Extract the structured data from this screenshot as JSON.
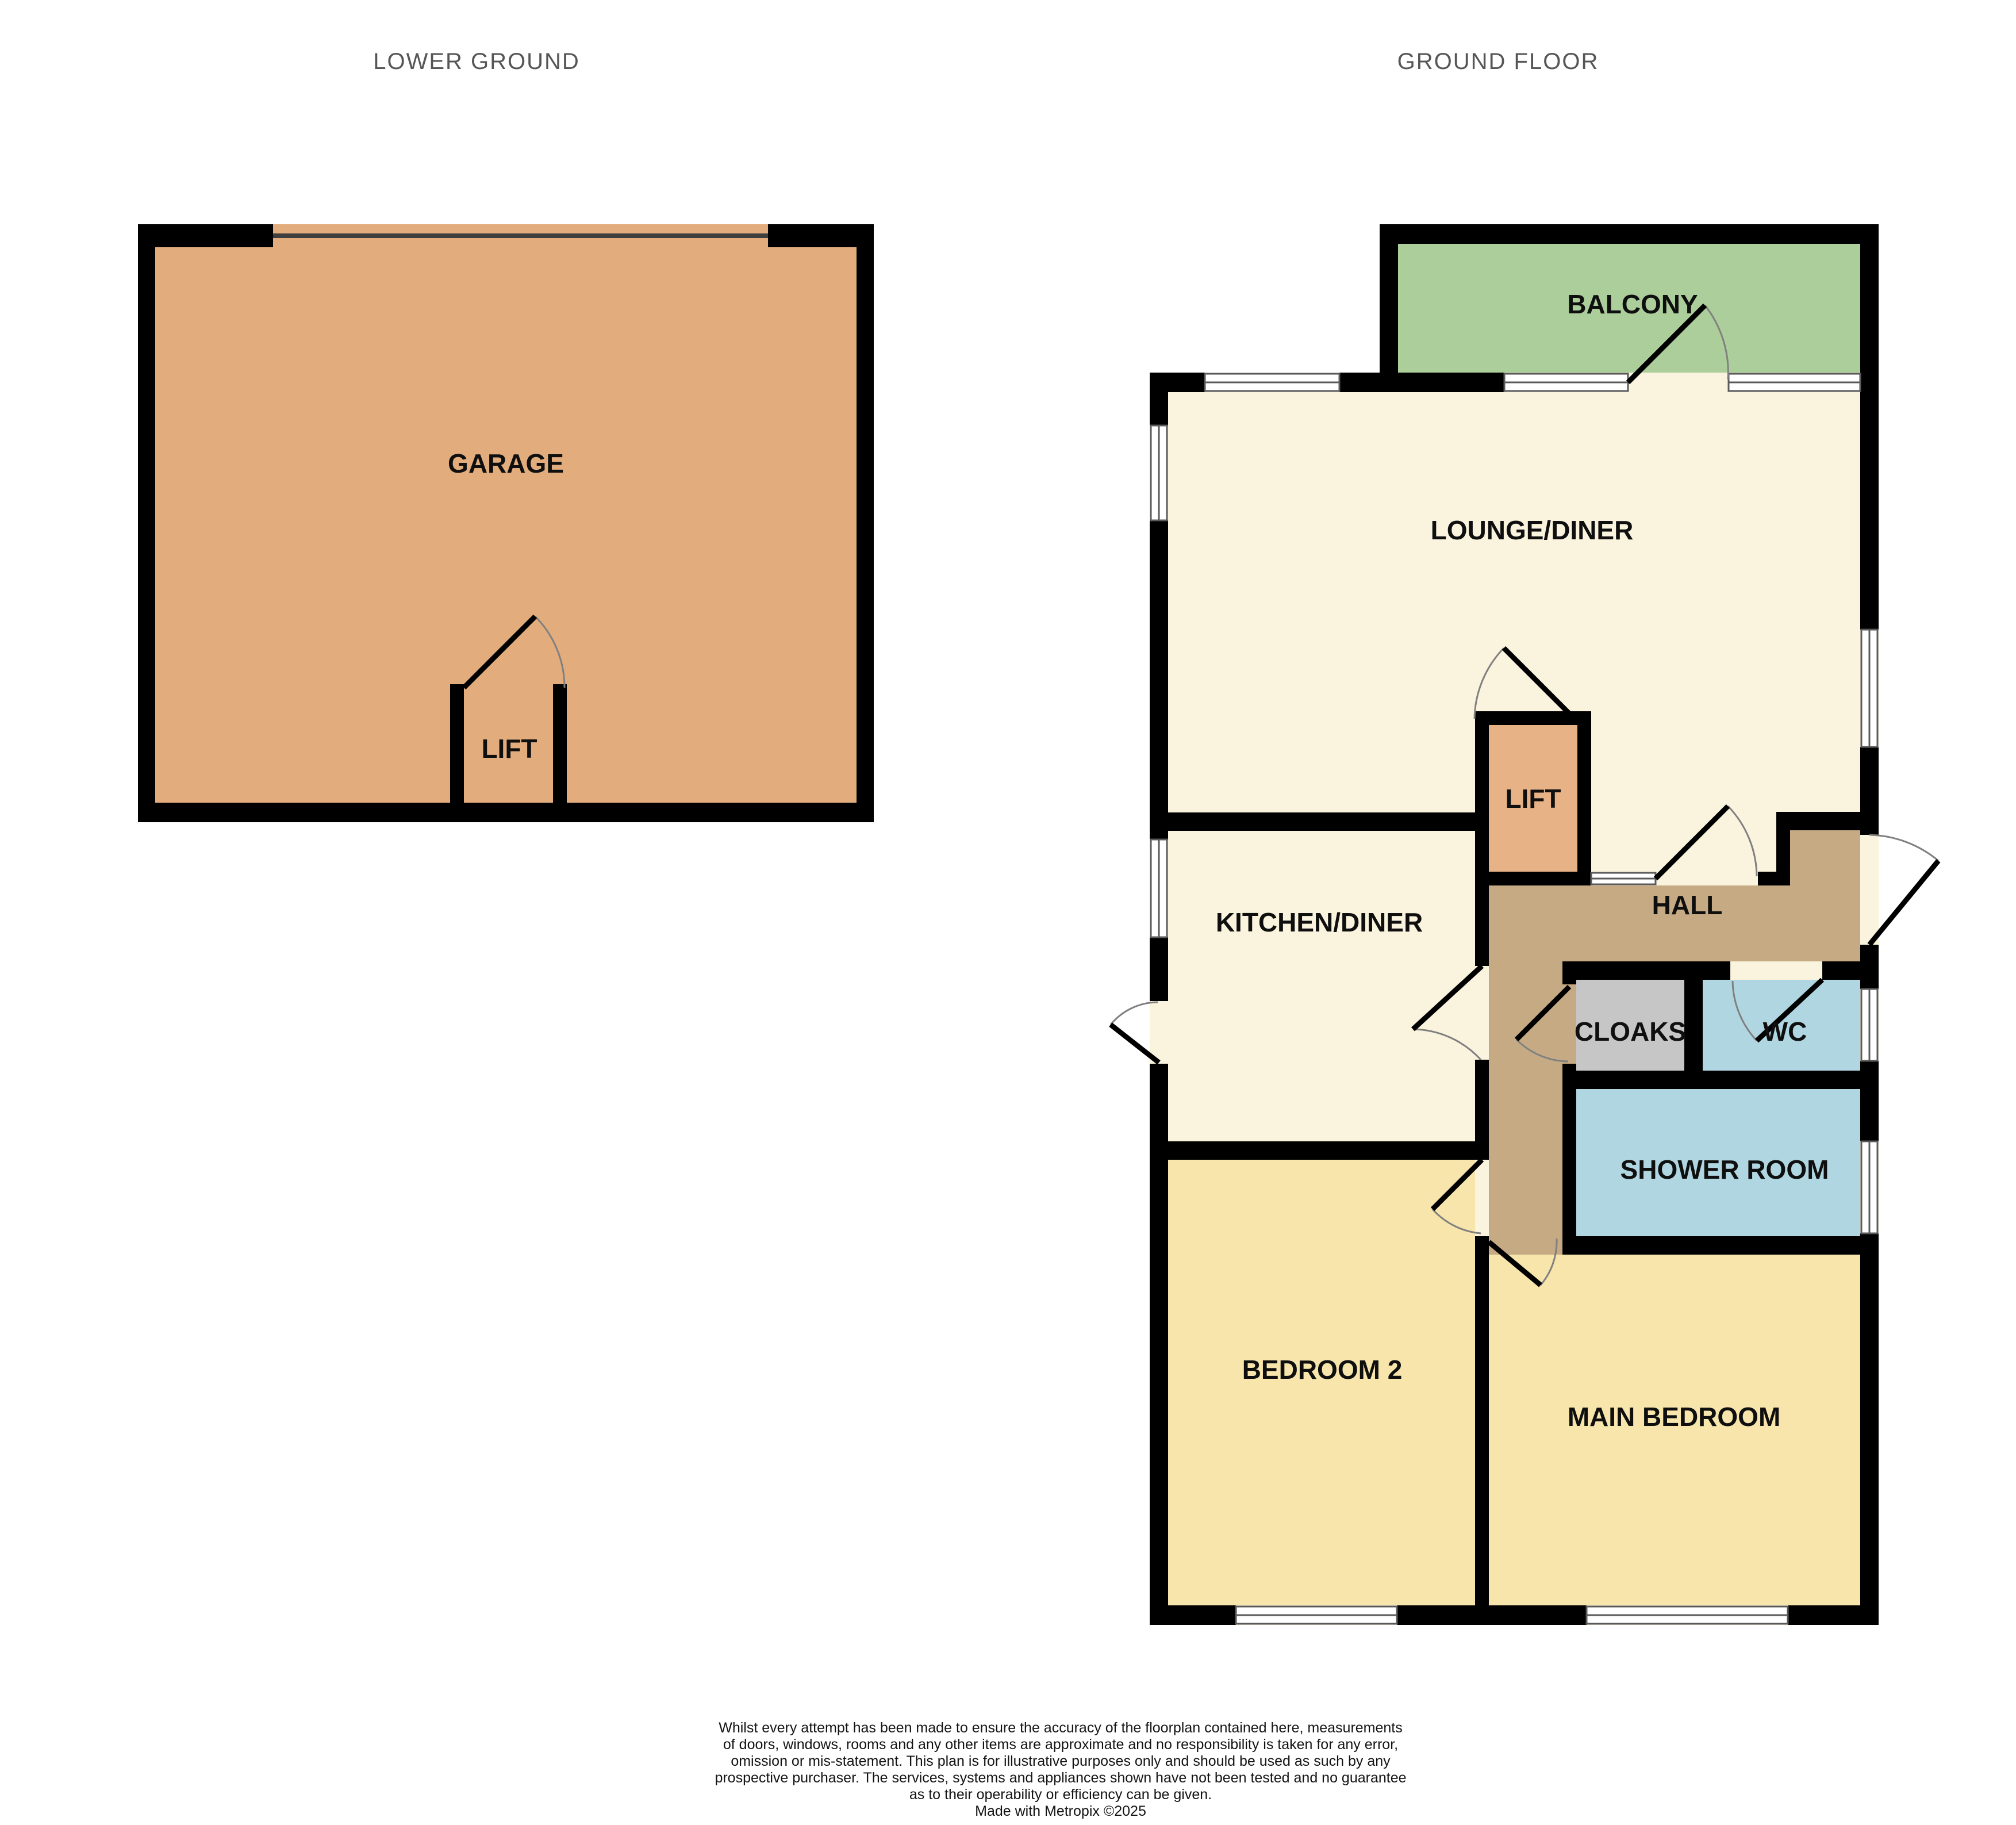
{
  "titles": {
    "lower_ground": "LOWER GROUND",
    "ground_floor": "GROUND FLOOR"
  },
  "rooms": {
    "garage": "GARAGE",
    "lift_lower": "LIFT",
    "balcony": "BALCONY",
    "lounge_diner": "LOUNGE/DINER",
    "lift_ground": "LIFT",
    "kitchen_diner": "KITCHEN/DINER",
    "hall": "HALL",
    "cloaks": "CLOAKS",
    "wc": "WC",
    "shower_room": "SHOWER ROOM",
    "bedroom_2": "BEDROOM 2",
    "main_bedroom": "MAIN BEDROOM"
  },
  "colors": {
    "wall": "#000000",
    "garage": "#E2AC7D",
    "lift": "#E7B286",
    "balcony": "#ABCE9B",
    "cream": "#FAF3DD",
    "hall": "#C5AA83",
    "cloaks": "#C6C6C6",
    "bathroom": "#B0D6E1",
    "bedroom": "#F7E5AB",
    "garage_door_line": "#3F3F3F",
    "title_text": "#565656",
    "label_text": "#0F0F0F",
    "disclaimer_text": "#141414",
    "window_fill": "#FFFFFF"
  },
  "disclaimer_lines": [
    "Whilst every attempt has been made to ensure the accuracy of the floorplan contained here, measurements",
    "of doors, windows, rooms and any other items are approximate and no responsibility is taken for any error,",
    "omission or mis-statement. This plan is for illustrative purposes only and should be used as such by any",
    "prospective purchaser. The services, systems and appliances shown have not been tested and no guarantee",
    "as to their operability or efficiency can be given.",
    "Made with Metropix ©2025"
  ]
}
